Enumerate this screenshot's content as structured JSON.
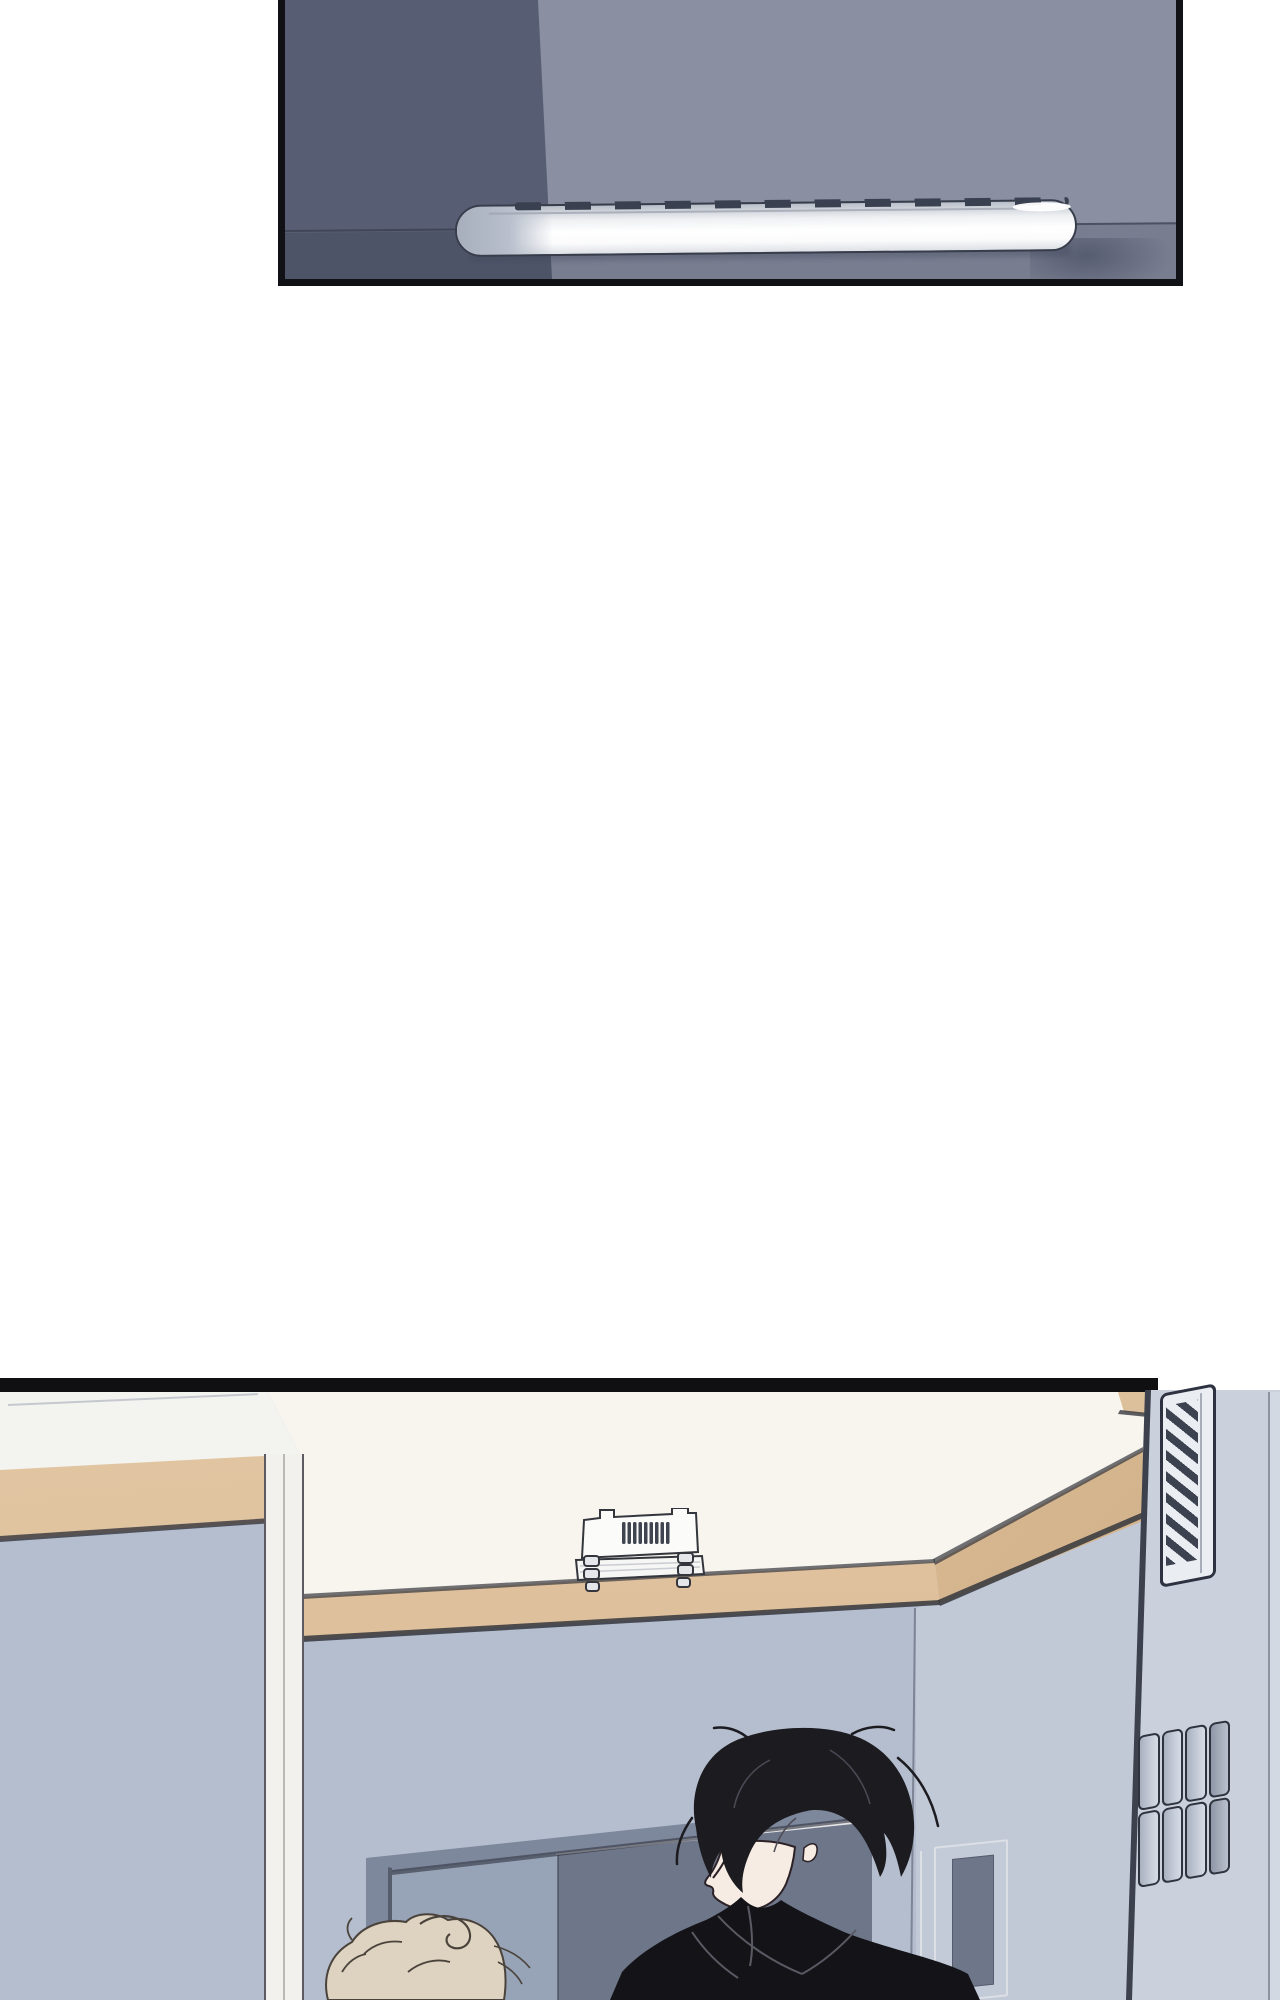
{
  "scene": {
    "type": "webtoon-comic-page",
    "panel_count": 2,
    "panels": [
      {
        "name": "top-panel",
        "subject": "ceiling corner seen from below with a fluorescent tube light fixture and soft wall shadow"
      },
      {
        "name": "bottom-panel",
        "subject": "room interior: tray ceiling with wood trim, ceiling-mounted unit, wall vent, decorative block shelf, doorway, glass panel, dark-haired figure in black coat, blond head at lower left"
      }
    ],
    "objects": [
      "fluorescent-light-bar",
      "ceiling-unit",
      "air-vent",
      "block-shelf-decor",
      "doorway-frame",
      "dark-opening",
      "glass-panel",
      "wood-crown-molding",
      "white-door-column",
      "dark-haired-man",
      "blond-person"
    ]
  },
  "colors": {
    "page": "#ffffff",
    "ink": "#101013",
    "panelBorder": "#111216",
    "ceilLight": "#8a90a2",
    "ceilDark": "#575e73",
    "seam": "rgba(60,64,80,0.8)",
    "wallTint": "rgba(22,26,44,0.15)",
    "lampOutline": "#383d4b",
    "dash": "#394050",
    "shadow": "rgba(64,70,90,0.6)",
    "cream": "#f8f5ee",
    "soffit": "#f3f3f0",
    "tan": "#dec19c",
    "tanDark": "#c9a87e",
    "outline": "#34363d",
    "wall": "#b5bece",
    "wallLight": "#c1c9d6",
    "pillar": "#cad1dd",
    "pillarEdge": "#3c414d",
    "pillarSide": "#d3d9e2",
    "ventBody": "#eaedf2",
    "ventSlat": "#3d4250",
    "ventFrame": "#2d3140",
    "frameGray": "#7e889d",
    "doorInterior": "#97a3b6",
    "doorDark": "#6e7689",
    "lightLine": "#e8e8ea",
    "glassFrame": "#dcdfe6",
    "hair": "#1b1b20",
    "hairLine": "#4b4b56",
    "face": "#f7ece3",
    "faceLine": "#2b2126",
    "blush": "#eac4bc",
    "coat": "#141418",
    "coatLine": "#5a5a64",
    "blonde": "#ded3c0",
    "blondeLine": "#4a433b",
    "blockFaceA": "#a9b1c0",
    "blockFaceB": "#d6dce5",
    "blockDark": "#8f97a8",
    "unitBody": "#fbfbf9",
    "unitSlat": "#3f4450"
  }
}
